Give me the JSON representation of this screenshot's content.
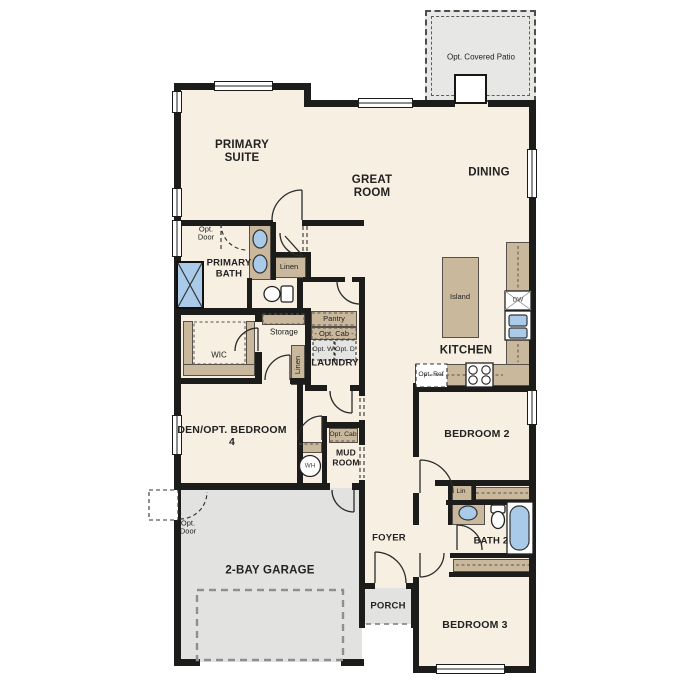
{
  "rooms": {
    "patio": "Opt. Covered Patio",
    "primary_suite": "PRIMARY SUITE",
    "great_room": "GREAT ROOM",
    "dining": "DINING",
    "kitchen": "KITCHEN",
    "primary_bath": "PRIMARY BATH",
    "wic": "WIC",
    "den": "DEN/OPT. BEDROOM 4",
    "laundry": "LAUNDRY",
    "mud_room": "MUD ROOM",
    "garage": "2-BAY GARAGE",
    "foyer": "FOYER",
    "porch": "PORCH",
    "bedroom2": "BEDROOM 2",
    "bedroom3": "BEDROOM 3",
    "bath2": "BATH 2"
  },
  "features": {
    "island": "Island",
    "pantry": "Pantry",
    "storage": "Storage",
    "linen": "Linen",
    "lin": "Lin",
    "opt_cab_dash": "- Opt. Cab -",
    "opt_cab": "Opt. Cab",
    "opt_washer": "Opt. W",
    "opt_dryer": "Opt. D",
    "opt_ref": "Opt. Ref",
    "opt_door": "Opt. Door",
    "dishwasher": "DW",
    "water_heater": "WH"
  },
  "colors": {
    "floor": "#f6efe2",
    "wall": "#1c1c1a",
    "cabinet": "#c9b89c",
    "exterior_gray": "#e2e2e0",
    "fixture_blue": "#a9cbe9"
  }
}
